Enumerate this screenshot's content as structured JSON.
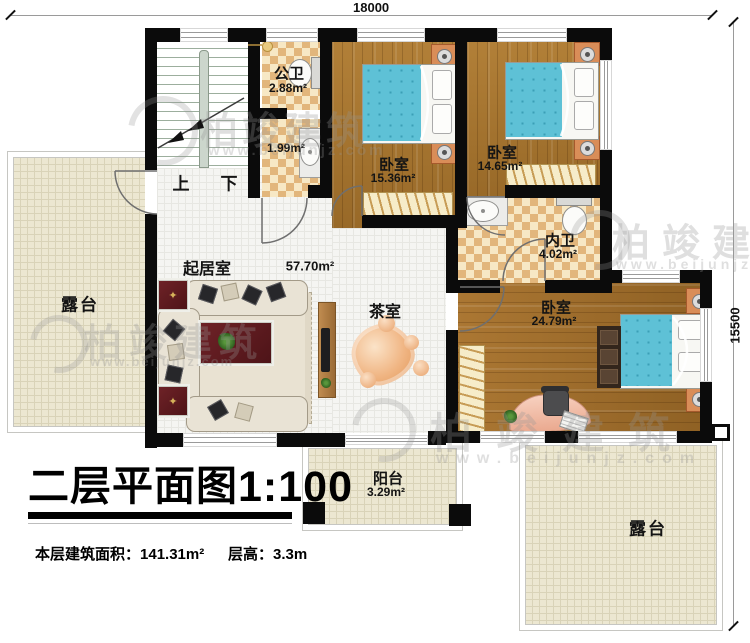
{
  "title": {
    "text": "二层平面图",
    "scale": "1:100"
  },
  "footer": {
    "area_label": "本层建筑面积：",
    "area_value": "141.31m²",
    "floor_height_label": "层高：",
    "floor_height_value": "3.3m"
  },
  "dimensions": {
    "width": "18000",
    "height": "15500"
  },
  "rooms": {
    "terrace_left": {
      "name": "露台"
    },
    "terrace_right": {
      "name": "露台"
    },
    "balcony": {
      "name": "阳台",
      "area": "3.29m²"
    },
    "living_room": {
      "name": "起居室",
      "area": "57.70m²"
    },
    "tea_room": {
      "name": "茶室"
    },
    "stairs": {
      "up": "上",
      "down": "下"
    },
    "public_bath": {
      "name": "公卫",
      "area": "2.88m²"
    },
    "washroom": {
      "area": "1.99m²"
    },
    "inner_bath": {
      "name": "内卫",
      "area": "4.02m²"
    },
    "bedroom1": {
      "name": "卧室",
      "area": "15.36m²"
    },
    "bedroom2": {
      "name": "卧室",
      "area": "14.65m²"
    },
    "bedroom3": {
      "name": "卧室",
      "area": "24.79m²"
    }
  },
  "watermark": {
    "brand": "柏竣建筑",
    "site": "www.beijunjz.com"
  }
}
